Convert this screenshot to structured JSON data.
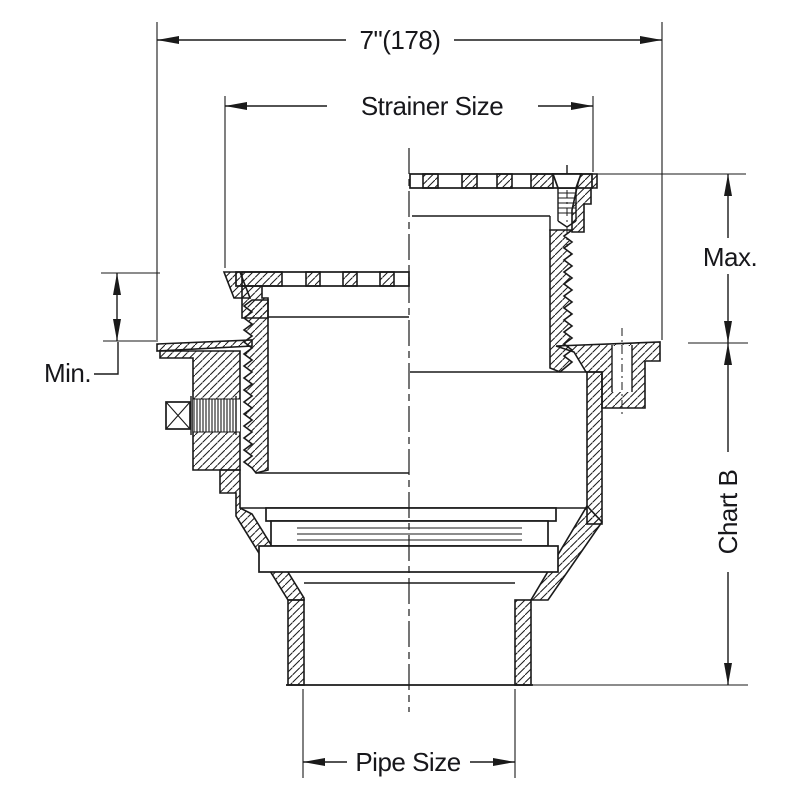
{
  "drawing": {
    "type": "technical-cross-section",
    "labels": {
      "total_width": "7\"(178)",
      "strainer_size": "Strainer Size",
      "max": "Max.",
      "min": "Min.",
      "chart_b": "Chart B",
      "pipe_size": "Pipe Size"
    },
    "colors": {
      "line": "#1a1a1a",
      "background": "#ffffff"
    }
  }
}
